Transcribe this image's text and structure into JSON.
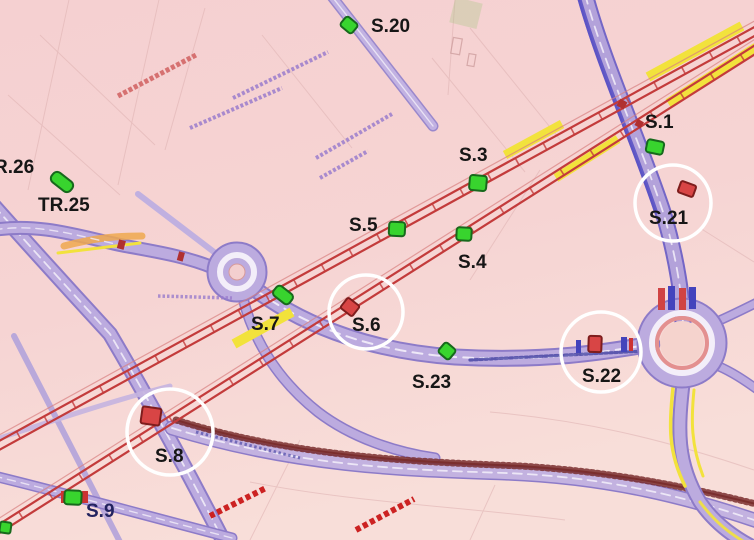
{
  "map": {
    "type": "traffic-plan-map",
    "stations": [
      {
        "id": "s20",
        "label": "S.20",
        "marker_color": "green",
        "circled": false
      },
      {
        "id": "r26",
        "label": "R.26",
        "marker_color": "none",
        "circled": false
      },
      {
        "id": "tr25",
        "label": "TR.25",
        "marker_color": "green",
        "circled": false
      },
      {
        "id": "s3",
        "label": "S.3",
        "marker_color": "green",
        "circled": false
      },
      {
        "id": "s5",
        "label": "S.5",
        "marker_color": "green",
        "circled": false
      },
      {
        "id": "s4",
        "label": "S.4",
        "marker_color": "green",
        "circled": false
      },
      {
        "id": "s7",
        "label": "S.7",
        "marker_color": "green",
        "circled": false
      },
      {
        "id": "s6",
        "label": "S.6",
        "marker_color": "red",
        "circled": true
      },
      {
        "id": "s23",
        "label": "S.23",
        "marker_color": "green",
        "circled": false
      },
      {
        "id": "s22",
        "label": "S.22",
        "marker_color": "red",
        "circled": true
      },
      {
        "id": "s1",
        "label": "S.1",
        "marker_color": "green",
        "circled": false
      },
      {
        "id": "s21",
        "label": "S.21",
        "marker_color": "red",
        "circled": true
      },
      {
        "id": "s8",
        "label": "S.8",
        "marker_color": "red",
        "circled": true
      },
      {
        "id": "s9",
        "label": "S.9",
        "marker_color": "green",
        "circled": false
      }
    ],
    "colors": {
      "background": "#f6d3d3",
      "road_fill": "#bcabdf",
      "road_edge": "#8d7bc8",
      "corridor_red": "#c33b3b",
      "highlight_yellow": "#f2e23c",
      "marker_green": "#38d42e",
      "marker_red": "#d84545",
      "highlight_circle": "#ffffff",
      "label_black": "#161616",
      "label_navy": "#23235f"
    }
  }
}
